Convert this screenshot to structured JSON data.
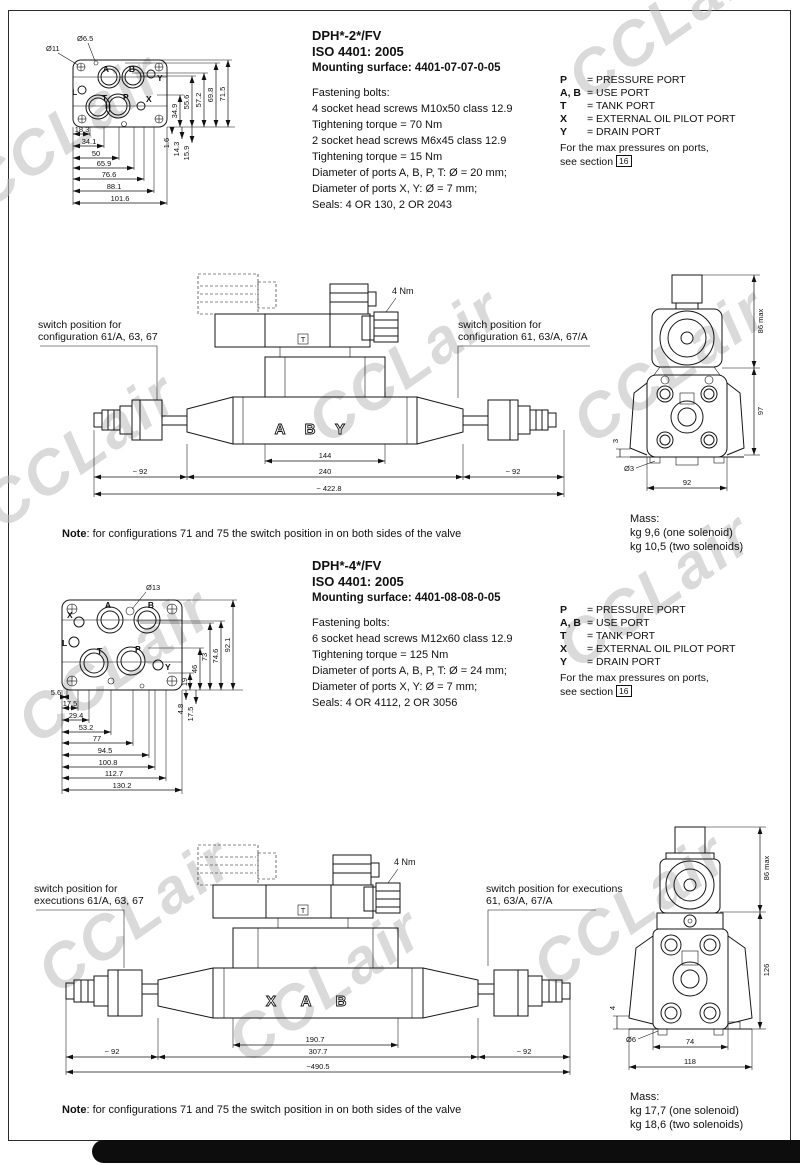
{
  "watermark": "CCLair",
  "legend": {
    "rows": [
      {
        "key": "P",
        "val": "= PRESSURE PORT"
      },
      {
        "key": "A, B",
        "val": "= USE PORT"
      },
      {
        "key": "T",
        "val": "= TANK PORT"
      },
      {
        "key": "X",
        "val": "= EXTERNAL OIL PILOT PORT"
      },
      {
        "key": "Y",
        "val": "= DRAIN PORT"
      }
    ],
    "max_line1": "For the max pressures on ports,",
    "max_line2": "see section",
    "section_ref": "16"
  },
  "s1": {
    "title": "DPH*-2*/FV",
    "iso": "ISO 4401: 2005",
    "mount": "Mounting surface: 4401-07-07-0-05",
    "specs": [
      "Fastening bolts:",
      "4 socket head screws M10x50 class 12.9",
      "Tightening torque = 70 Nm",
      "2 socket head screws M6x45 class 12.9",
      "Tightening torque = 15 Nm",
      "Diameter of ports A, B, P, T: Ø = 20 mm;",
      "Diameter of ports X, Y: Ø = 7 mm;",
      "Seals: 4 OR 130, 2 OR 2043"
    ],
    "plate": {
      "hole1": "Ø11",
      "hole2": "Ø6.5",
      "ports": {
        "L": "L",
        "A": "A",
        "B": "B",
        "Y": "Y",
        "T": "T",
        "P": "P",
        "X": "X"
      },
      "hdims": [
        "18.3",
        "34.1",
        "50",
        "65.9",
        "76.6",
        "88.1",
        "101.6"
      ],
      "vdims": [
        "34.9",
        "55.6",
        "57.2",
        "69.8",
        "71.5"
      ],
      "vsmall": [
        "1.6",
        "14.3",
        "15.9"
      ]
    },
    "valve": {
      "sw_left1": "switch position for",
      "sw_left2": "configuration 61/A, 63, 67",
      "sw_right1": "switch position for",
      "sw_right2": "configuration 61, 63/A, 67/A",
      "torque": "4 Nm",
      "t_mark": "T",
      "letters": [
        "A",
        "B",
        "Y"
      ],
      "dim_inner": "144",
      "dim_mid": "240",
      "dim_side_l": "~ 92",
      "dim_side_r": "~ 92",
      "dim_total": "~ 422.8"
    },
    "end": {
      "d_top": "86 max",
      "d_mid": "97",
      "d_bottom": "92",
      "d_hole": "Ø3",
      "d_small": "3"
    },
    "mass": {
      "label": "Mass:",
      "one": "kg 9,6 (one solenoid)",
      "two": "kg 10,5 (two solenoids)"
    },
    "note_label": "Note",
    "note_text": ": for configurations 71 and 75 the switch position in on both sides of the valve"
  },
  "s2": {
    "title": "DPH*-4*/FV",
    "iso": "ISO 4401: 2005",
    "mount": "Mounting surface: 4401-08-08-0-05",
    "specs": [
      "Fastening bolts:",
      "6 socket head screws M12x60 class 12.9",
      "Tightening torque = 125 Nm",
      "Diameter of ports A, B, P, T: Ø = 24 mm;",
      "Diameter of ports X, Y: Ø = 7 mm;",
      "Seals: 4 OR 4112, 2 OR 3056"
    ],
    "plate": {
      "hole1": "Ø13",
      "ports": {
        "X": "X",
        "L": "L",
        "A": "A",
        "B": "B",
        "T": "T",
        "P": "P",
        "Y": "Y"
      },
      "hdims": [
        "5.6",
        "17.5",
        "29.4",
        "53.2",
        "77",
        "94.5",
        "100.8",
        "112.7",
        "130.2"
      ],
      "vdims": [
        "19",
        "46",
        "73",
        "74.6",
        "92.1"
      ],
      "vsmall": [
        "4.8",
        "17.5"
      ]
    },
    "valve": {
      "sw_left1": "switch position for",
      "sw_left2": "executions 61/A, 63, 67",
      "sw_right1": "switch position for executions",
      "sw_right2": "61, 63/A, 67/A",
      "torque": "4 Nm",
      "t_mark": "T",
      "letters": [
        "X",
        "A",
        "B"
      ],
      "dim_inner": "190.7",
      "dim_mid": "307.7",
      "dim_side_l": "~ 92",
      "dim_side_r": "~ 92",
      "dim_total": "~490.5"
    },
    "end": {
      "d_top": "86 max",
      "d_mid": "126",
      "d_b_inner": "74",
      "d_b_outer": "118",
      "d_hole": "Ø6",
      "d_small": "4"
    },
    "mass": {
      "label": "Mass:",
      "one": "kg 17,7 (one solenoid)",
      "two": "kg 18,6 (two solenoids)"
    },
    "note_label": "Note",
    "note_text": ": for configurations 71 and 75 the switch position in on both sides of the valve"
  }
}
